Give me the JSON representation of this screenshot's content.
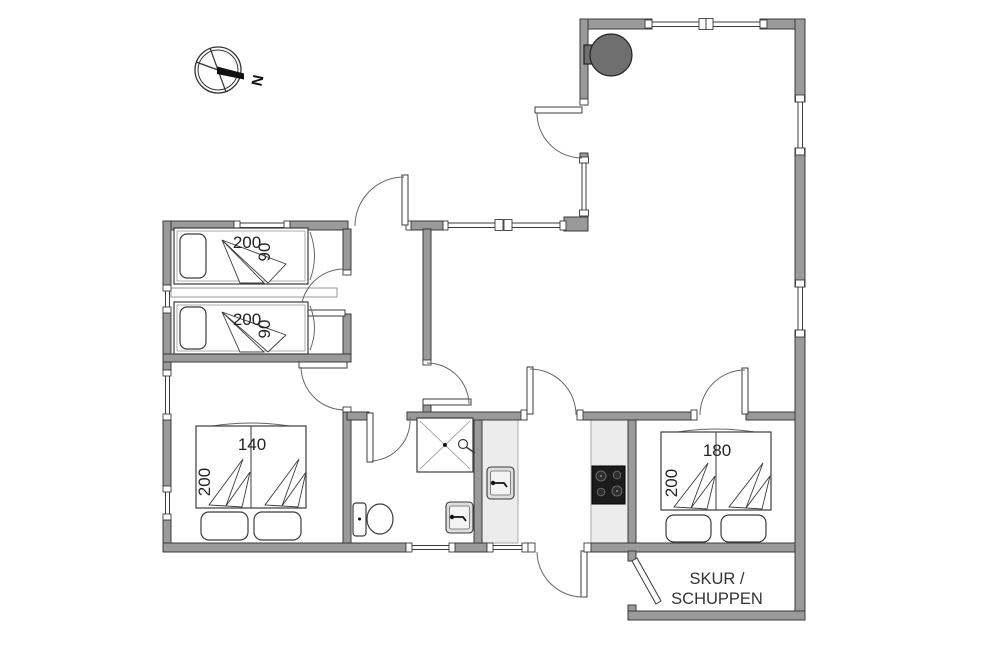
{
  "compass": {
    "north_label": "N"
  },
  "bedroom_top": {
    "bed1": {
      "length": "200",
      "width": "90"
    },
    "bed2": {
      "length": "200",
      "width": "90"
    }
  },
  "bedroom_left": {
    "bed_width": "140",
    "bed_length": "200"
  },
  "bedroom_right": {
    "bed_width": "180",
    "bed_length": "200"
  },
  "shed": {
    "label_line1": "SKUR /",
    "label_line2": "SCHUPPEN"
  },
  "colors": {
    "floor": "#ffffff",
    "wall_fill": "#9a9a9a",
    "wall_stroke": "#3b3b3b",
    "counter_fill": "#ececec",
    "stove_fill": "#6f6f6f",
    "cooktop_fill": "#1c1c1c"
  }
}
